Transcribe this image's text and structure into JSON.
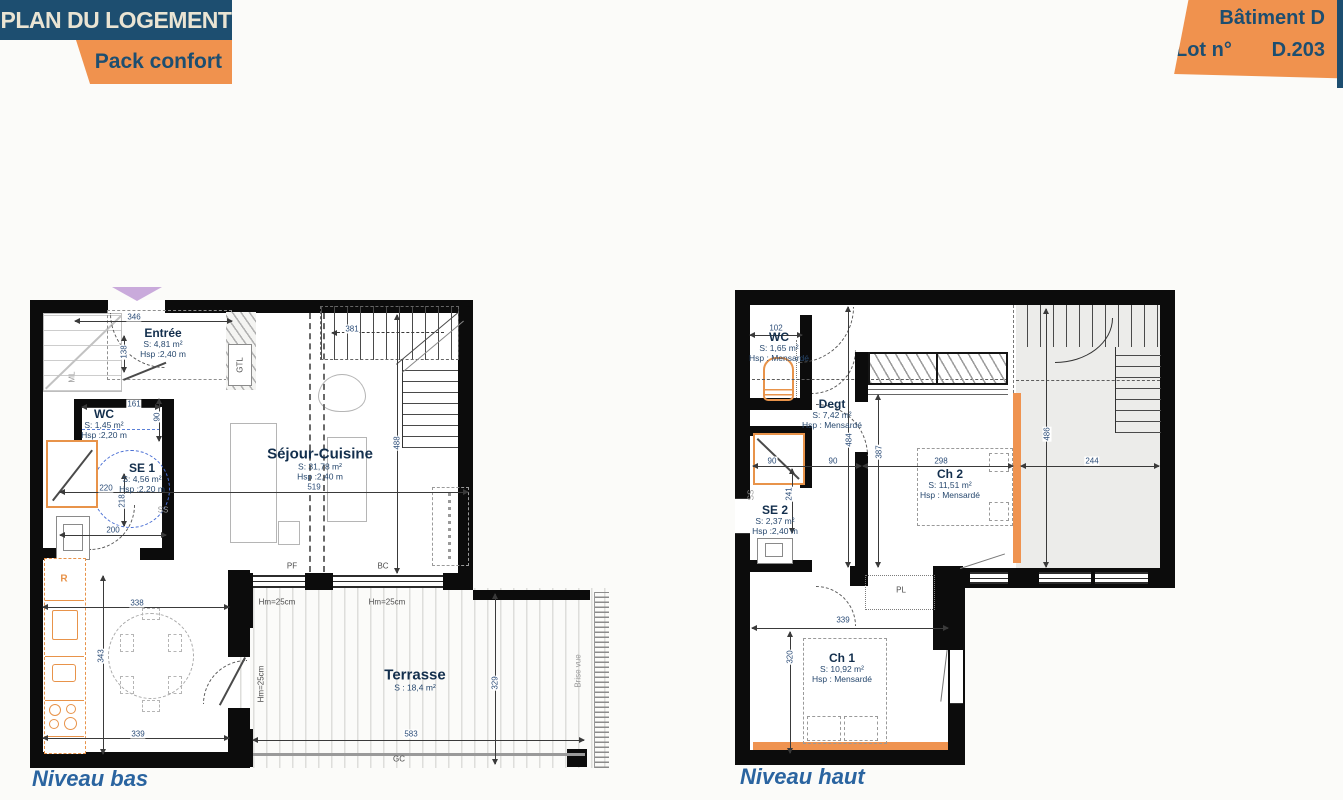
{
  "header": {
    "title": "PLAN DU LOGEMENT",
    "pack": "Pack confort",
    "batiment": "Bâtiment D",
    "lot_label": "Lot n°",
    "lot_value": "D.203"
  },
  "colors": {
    "navy": "#1d4e70",
    "orange": "#f0924e",
    "cream": "#eae4d3",
    "caption_blue": "#2a64a0",
    "dim_blue": "#2c4d78",
    "fixture_orange": "#e8934a"
  },
  "plan_bas": {
    "caption": "Niveau bas",
    "labels": [
      {
        "k": "room",
        "n": "Entrée",
        "a": "S: 4,81 m²",
        "h": "Hsp :2,40 m",
        "x": 163,
        "y": 343
      },
      {
        "k": "room",
        "n": "WC",
        "a": "S: 1,45 m²",
        "h": "Hsp :2,20 m",
        "x": 104,
        "y": 424
      },
      {
        "k": "room",
        "n": "SE 1",
        "a": "S: 4,56 m²",
        "h": "Hsp :2,20 m",
        "x": 142,
        "y": 478
      },
      {
        "k": "room",
        "big": true,
        "n": "Séjour-Cuisine",
        "a": "S: 31,78 m²",
        "h": "Hsp :2,40 m",
        "x": 320,
        "y": 464
      },
      {
        "k": "room",
        "big": true,
        "n": "Terrasse",
        "a": "S : 18,4 m²",
        "x": 415,
        "y": 680
      },
      {
        "k": "dim",
        "t": "346",
        "x": 134,
        "y": 317
      },
      {
        "k": "dim",
        "t": "138",
        "x": 124,
        "y": 352,
        "v": true
      },
      {
        "k": "dim",
        "t": "161",
        "x": 134,
        "y": 404
      },
      {
        "k": "dim",
        "t": "90",
        "x": 157,
        "y": 417,
        "v": true
      },
      {
        "k": "dim",
        "t": "381",
        "x": 352,
        "y": 329
      },
      {
        "k": "dim",
        "t": "220",
        "x": 106,
        "y": 488
      },
      {
        "k": "dim",
        "t": "218",
        "x": 122,
        "y": 501,
        "v": true
      },
      {
        "k": "dim",
        "t": "200",
        "x": 113,
        "y": 530
      },
      {
        "k": "dim",
        "t": "519",
        "x": 314,
        "y": 487
      },
      {
        "k": "dim",
        "t": "488",
        "x": 397,
        "y": 443,
        "v": true
      },
      {
        "k": "dim",
        "t": "338",
        "x": 137,
        "y": 603
      },
      {
        "k": "dim",
        "t": "343",
        "x": 101,
        "y": 656,
        "v": true
      },
      {
        "k": "dim",
        "t": "339",
        "x": 138,
        "y": 734
      },
      {
        "k": "dim",
        "t": "583",
        "x": 411,
        "y": 734
      },
      {
        "k": "dim",
        "t": "329",
        "x": 495,
        "y": 683,
        "v": true
      },
      {
        "k": "tag",
        "t": "ML",
        "x": 72,
        "y": 377,
        "v": true,
        "c": "gray"
      },
      {
        "k": "tag",
        "t": "GTL",
        "x": 240,
        "y": 365,
        "v": true
      },
      {
        "k": "tag",
        "t": "R",
        "x": 64,
        "y": 579,
        "c": "orange"
      },
      {
        "k": "tag",
        "t": "SS",
        "x": 163,
        "y": 510,
        "c": "gray"
      },
      {
        "k": "tag",
        "t": "PF",
        "x": 292,
        "y": 566
      },
      {
        "k": "tag",
        "t": "BC",
        "x": 383,
        "y": 566
      },
      {
        "k": "tag",
        "t": "Hm=25cm",
        "x": 277,
        "y": 602
      },
      {
        "k": "tag",
        "t": "Hm=25cm",
        "x": 387,
        "y": 602
      },
      {
        "k": "tag",
        "t": "Hm=25cm",
        "x": 261,
        "y": 684,
        "v": true
      },
      {
        "k": "tag",
        "t": "GC",
        "x": 399,
        "y": 759
      },
      {
        "k": "tag",
        "t": "Brise vue",
        "x": 578,
        "y": 671,
        "v": true,
        "c": "gray"
      }
    ]
  },
  "plan_haut": {
    "caption": "Niveau haut",
    "labels": [
      {
        "k": "room",
        "n": "WC",
        "a": "S: 1,65 m²",
        "h": "Hsp : Mensardé",
        "x": 779,
        "y": 347
      },
      {
        "k": "room",
        "n": "Degt",
        "a": "S: 7,42 m²",
        "h": "Hsp : Mensardé",
        "x": 832,
        "y": 414
      },
      {
        "k": "room",
        "n": "SE 2",
        "a": "S: 2,37 m²",
        "h": "Hsp :2,40 m",
        "x": 775,
        "y": 520
      },
      {
        "k": "room",
        "n": "Ch 2",
        "a": "S: 11,51 m²",
        "h": "Hsp : Mensardé",
        "x": 950,
        "y": 484
      },
      {
        "k": "room",
        "n": "Ch 1",
        "a": "S: 10,92 m²",
        "h": "Hsp : Mensardé",
        "x": 842,
        "y": 668
      },
      {
        "k": "dim",
        "t": "102",
        "x": 776,
        "y": 328
      },
      {
        "k": "dim",
        "t": "484",
        "x": 849,
        "y": 440,
        "v": true
      },
      {
        "k": "dim",
        "t": "90",
        "x": 772,
        "y": 461
      },
      {
        "k": "dim",
        "t": "90",
        "x": 833,
        "y": 461
      },
      {
        "k": "dim",
        "t": "241",
        "x": 789,
        "y": 494,
        "v": true
      },
      {
        "k": "dim",
        "t": "387",
        "x": 879,
        "y": 452,
        "v": true
      },
      {
        "k": "dim",
        "t": "298",
        "x": 941,
        "y": 461
      },
      {
        "k": "dim",
        "t": "244",
        "x": 1092,
        "y": 461
      },
      {
        "k": "dim",
        "t": "486",
        "x": 1047,
        "y": 434,
        "v": true
      },
      {
        "k": "dim",
        "t": "339",
        "x": 843,
        "y": 620
      },
      {
        "k": "dim",
        "t": "320",
        "x": 790,
        "y": 657,
        "v": true
      },
      {
        "k": "tag",
        "t": "SS",
        "x": 751,
        "y": 495,
        "v": true,
        "c": "gray"
      },
      {
        "k": "tag",
        "t": "PL",
        "x": 901,
        "y": 590
      }
    ]
  }
}
